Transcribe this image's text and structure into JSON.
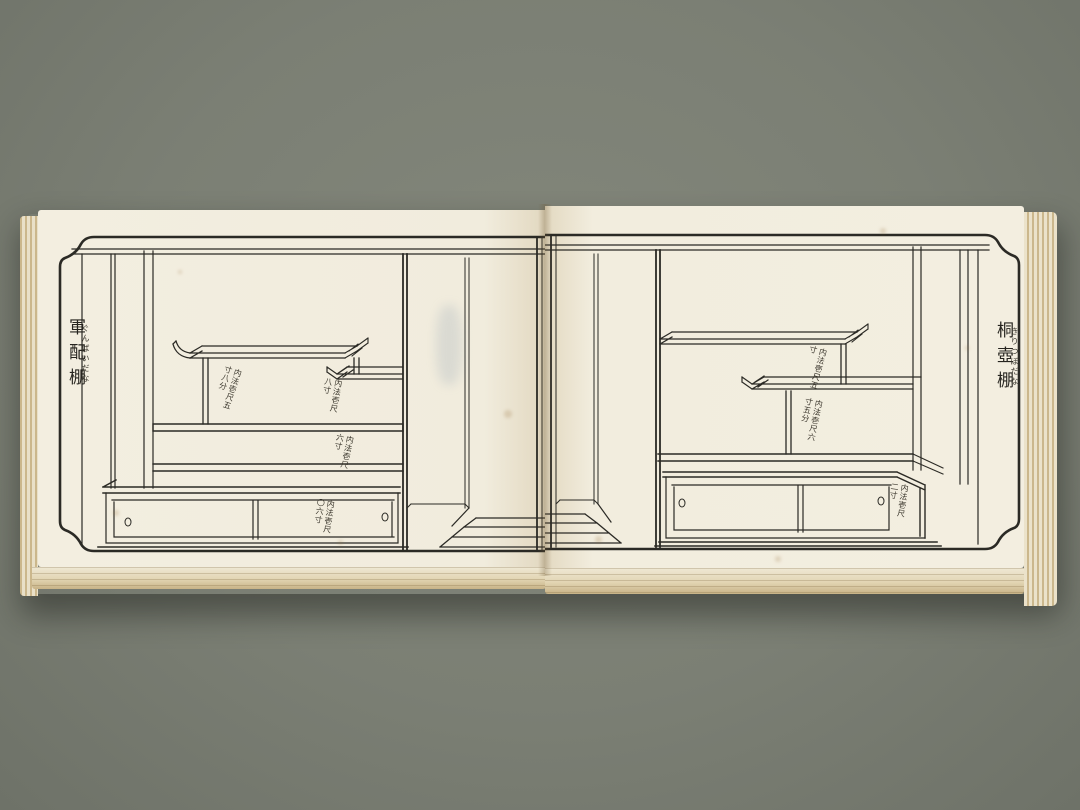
{
  "photo": {
    "background_color": "#7b7f74",
    "book": {
      "paper_color": "#f1ecdd",
      "ink_color": "#2b2a25",
      "page_edge_color": "#d8c69e",
      "left_page": {
        "title": "軍配棚",
        "title_furigana": "ぐんばいだな",
        "annotations": [
          {
            "text": "内法壱尺五寸八分"
          },
          {
            "text": "内法壱尺八寸"
          },
          {
            "text": "内法壱尺六寸"
          },
          {
            "text": "内法壱尺〇六寸"
          }
        ]
      },
      "right_page": {
        "title": "桐壺棚",
        "title_furigana": "きりつぼだな",
        "annotations": [
          {
            "text": "内法壱尺五寸"
          },
          {
            "text": "内法壱尺六寸五分"
          },
          {
            "text": "内法壱尺二寸"
          }
        ]
      }
    }
  }
}
